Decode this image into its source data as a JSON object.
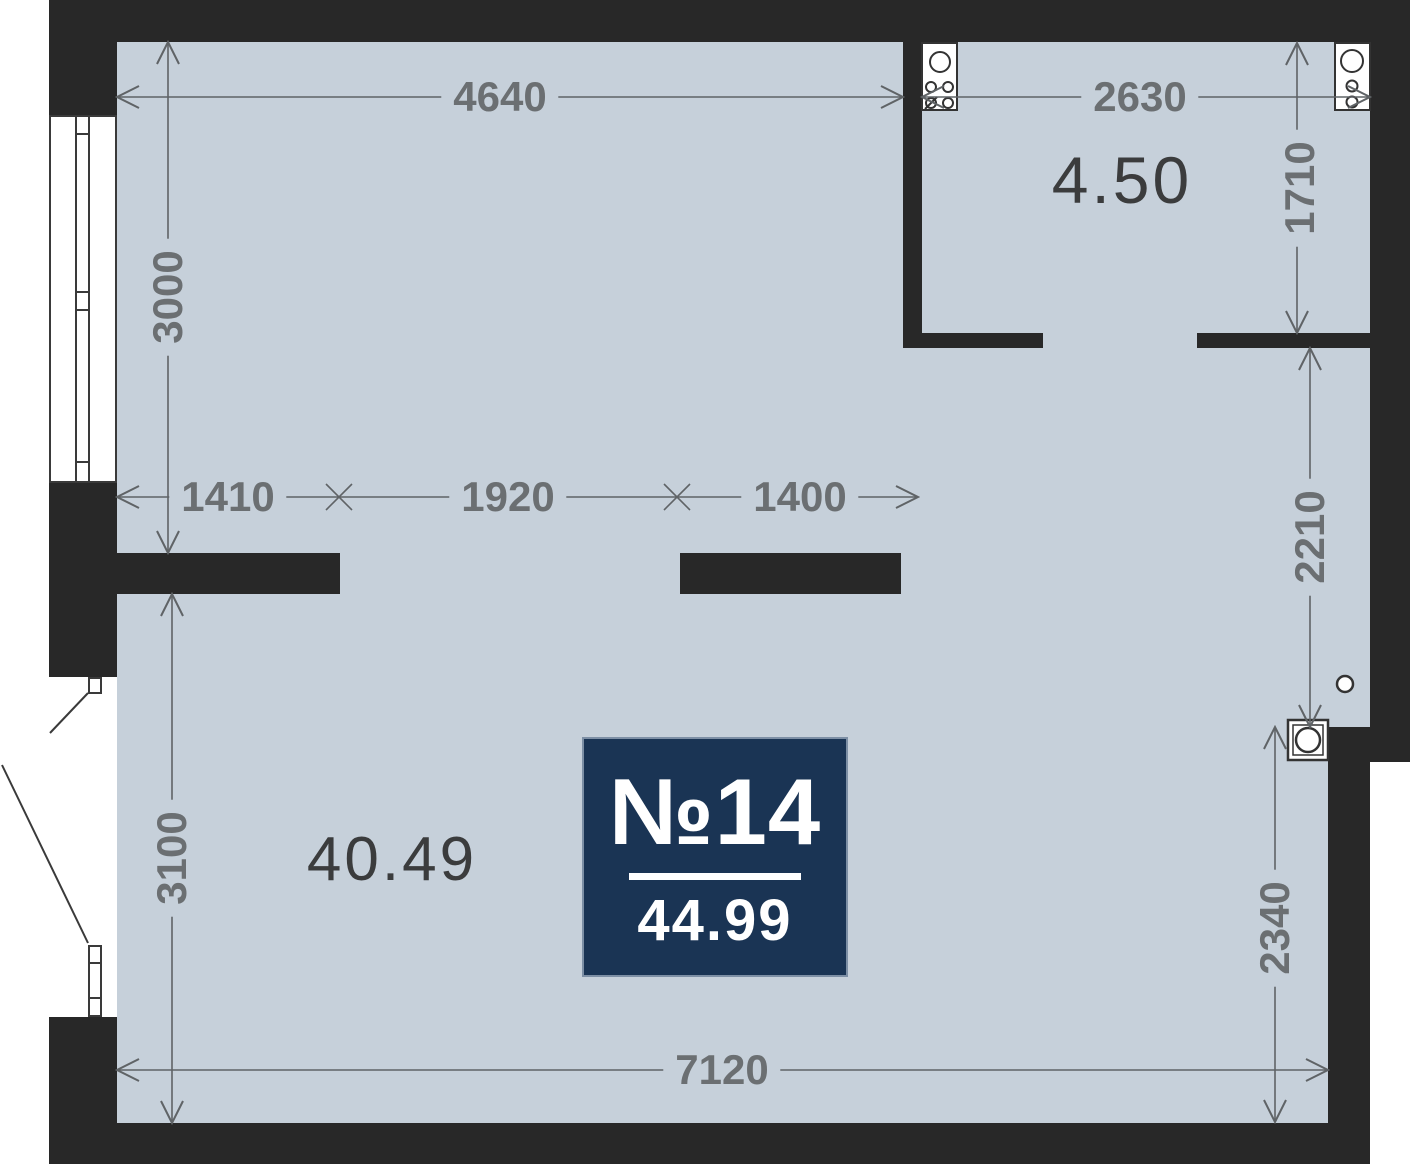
{
  "plan": {
    "unit_badge": {
      "number": "№14",
      "area": "44.99"
    },
    "rooms": [
      {
        "id": "main-room",
        "area_label": "40.49"
      },
      {
        "id": "kitchen",
        "area_label": "4.50"
      }
    ],
    "dimensions": {
      "top_left_width": "4640",
      "top_right_width": "2630",
      "left_upper_height": "3000",
      "kitchen_height": "1710",
      "mid_left_width": "1410",
      "mid_center_width": "1920",
      "mid_right_width": "1400",
      "right_upper_height": "2210",
      "left_lower_height": "3100",
      "right_lower_height": "2340",
      "bottom_width": "7120"
    },
    "colors": {
      "wall": "#282828",
      "floor": "#c6d0da",
      "badge": "#1a3454",
      "dimension_text": "#6b6f72",
      "area_text": "#3b3c3d"
    },
    "icons": [
      "stove-icon",
      "sink-icon",
      "washer-icon",
      "floor-drain-icon",
      "window-symbol",
      "door-swing-icon"
    ]
  }
}
